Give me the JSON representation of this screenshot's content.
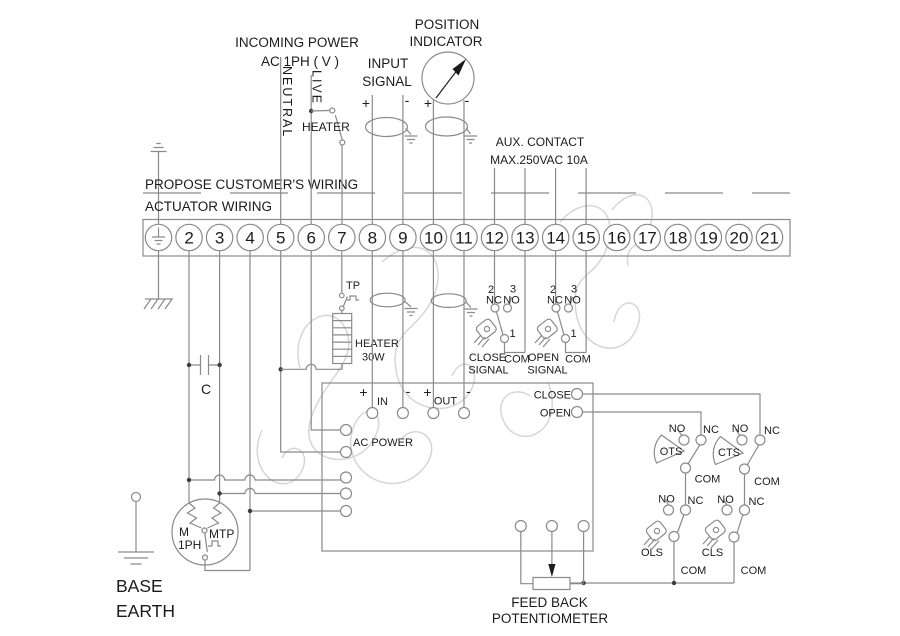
{
  "diagram_title": "actuator wiring diagram",
  "boundary": {
    "customer_side": "PROPOSE CUSTOMER'S WIRING",
    "actuator_side": "ACTUATOR WIRING"
  },
  "incoming_power": {
    "line1": "INCOMING POWER",
    "line2": "AC 1PH ( V )",
    "neutral": "NEUTRAL",
    "live": "LIVE",
    "heater_switch": "HEATER"
  },
  "input_signal": {
    "line1": "INPUT",
    "line2": "SIGNAL"
  },
  "position_indicator": {
    "line1": "POSITION",
    "line2": "INDICATOR"
  },
  "aux_contact": {
    "line1": "AUX. CONTACT",
    "line2": "MAX.250VAC 10A"
  },
  "terminal_strip": {
    "numbers": [
      "2",
      "3",
      "4",
      "5",
      "6",
      "7",
      "8",
      "9",
      "10",
      "11",
      "12",
      "13",
      "14",
      "15",
      "16",
      "17",
      "18",
      "19",
      "20",
      "21"
    ]
  },
  "markers": {
    "plus": "+",
    "minus": "-",
    "in": "IN",
    "out": "OUT",
    "nc": "NC",
    "no": "NO",
    "com": "COM",
    "n1": "1",
    "n2": "2",
    "n3": "3"
  },
  "heater": {
    "tp": "TP",
    "name": "HEATER",
    "power": "30W"
  },
  "aux_switches": {
    "close_line1": "CLOSE",
    "close_line2": "SIGNAL",
    "open_line1": "OPEN",
    "open_line2": "SIGNAL"
  },
  "controller": {
    "ac_power": "AC POWER",
    "close": "CLOSE",
    "open": "OPEN"
  },
  "limit_switches": {
    "ots": "OTS",
    "cts": "CTS",
    "ols": "OLS",
    "cls": "CLS"
  },
  "motor": {
    "m": "M",
    "phase": "1PH",
    "mtp": "MTP",
    "capacitor": "C"
  },
  "feedback": {
    "line1": "FEED BACK",
    "line2": "POTENTIOMETER"
  },
  "base_earth": {
    "line1": "BASE",
    "line2": "EARTH"
  },
  "colors": {
    "wire": "#8a8a8a",
    "text": "#1b1b1b",
    "watermark": "#d2d2d2",
    "background": "#ffffff"
  }
}
